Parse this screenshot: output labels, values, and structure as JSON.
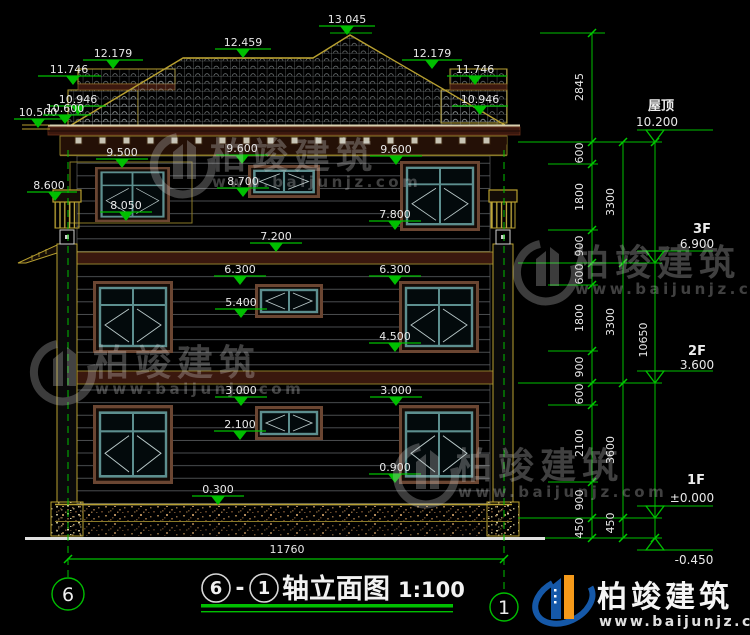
{
  "drawing_title": {
    "axis_start": "6",
    "separator": "-",
    "axis_end": "1",
    "name": "轴立面图",
    "scale": "1:100"
  },
  "grid_bubbles": {
    "left": "6",
    "right": "1"
  },
  "floor_levels": [
    {
      "label": "屋顶",
      "value": "10.200"
    },
    {
      "label": "3F",
      "value": "6.900"
    },
    {
      "label": "2F",
      "value": "3.600"
    },
    {
      "label": "1F",
      "value": "±0.000"
    },
    {
      "label": "",
      "value": "-0.450"
    }
  ],
  "elevation_marks": [
    "13.045",
    "12.459",
    "12.179",
    "12.179",
    "11.746",
    "11.746",
    "10.946",
    "10.946",
    "10.500",
    "10.600",
    "9.500",
    "9.600",
    "9.600",
    "8.600",
    "8.700",
    "8.050",
    "7.800",
    "7.200",
    "6.300",
    "6.300",
    "5.400",
    "4.500",
    "3.000",
    "3.000",
    "2.100",
    "0.900",
    "0.300"
  ],
  "dim_chains": {
    "roof_height": "2845",
    "fine": [
      "600",
      "1800",
      "900",
      "600",
      "1800",
      "900",
      "600",
      "2100",
      "900",
      "450"
    ],
    "floors": [
      "3300",
      "3300",
      "3600",
      "450"
    ],
    "total_height": "10650",
    "total_width": "11760"
  },
  "watermark": {
    "brand": "柏竣建筑",
    "url": "www.baijunjz.com"
  },
  "footer_logo": {
    "brand": "柏竣建筑",
    "url": "www.baijunjz.com"
  },
  "colors": {
    "background": "#000000",
    "dimension_green": "#00bf00",
    "annotation_text": "#e9e9e9",
    "roof_trim_yellow": "#b8a030",
    "window_frame_teal": "#5d8f8f",
    "window_trim_brown": "#6b4632",
    "logo_blue": "#1558a8",
    "logo_orange": "#f59a1a"
  }
}
